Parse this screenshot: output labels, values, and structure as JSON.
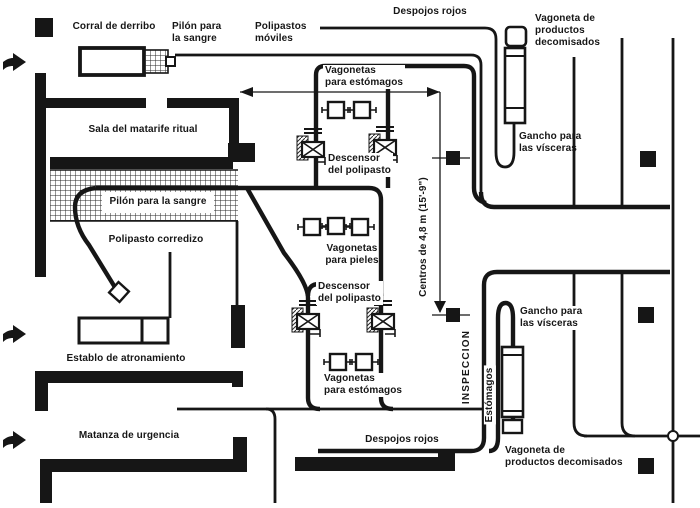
{
  "title": "Plano de matadero",
  "colors": {
    "ink": "#161616",
    "background": "#ffffff"
  },
  "labels": {
    "corral": "Corral de derribo",
    "pilon_top": "Pilón para\nla sangre",
    "polipastos_moviles": "Polipastos\nmóviles",
    "despojos_top": "Despojos rojos",
    "vagoneta_top": "Vagoneta de\nproductos\ndecomisados",
    "sala": "Sala del matarife ritual",
    "pilon_band": "Pilón para la sangre",
    "polipasto_corredizo": "Polipasto corredizo",
    "vagonetas_estomagos_top": "Vagonetas\npara estómagos",
    "descensor_top": "Descensor\ndel polipasto",
    "vagonetas_pieles": "Vagonetas\npara pieles",
    "descensor_bottom": "Descensor\ndel polipasto",
    "vagonetas_estomagos_bottom": "Vagonetas\npara estómagos",
    "gancho_top": "Gancho para\nlas vísceras",
    "gancho_bottom": "Gancho para\nlas vísceras",
    "establo": "Establo de atronamiento",
    "matanza": "Matanza de urgencia",
    "despojos_bottom": "Despojos rojos",
    "vagoneta_bottom": "Vagoneta de\nproductos decomisados",
    "inspeccion": "INSPECCION",
    "estomagos": "Estómagos",
    "centros": "Centros de 4,8 m (15'-9\")"
  }
}
